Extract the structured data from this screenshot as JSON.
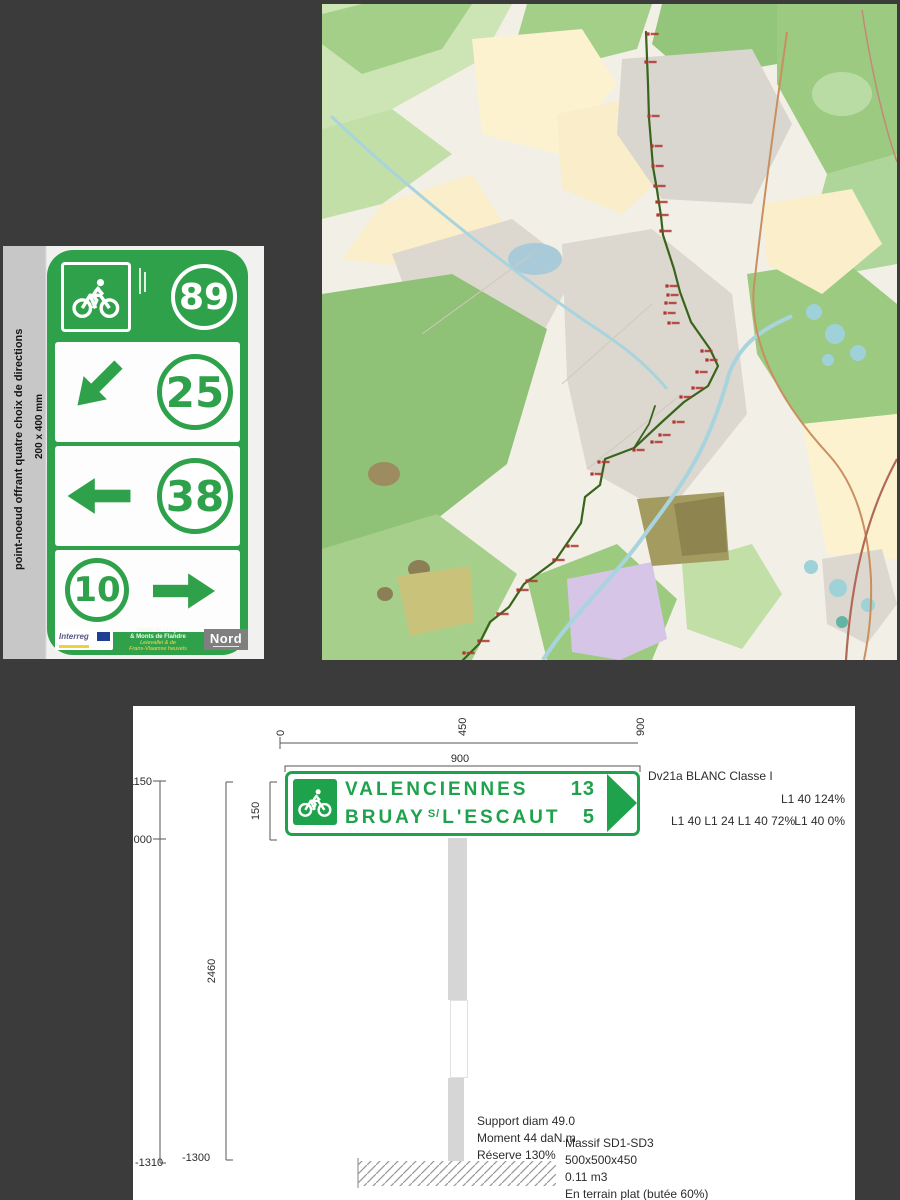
{
  "colors": {
    "canvas_bg": "#3b3b3b",
    "sign_green": "#2fa14b",
    "drawing_green": "#1fa24c",
    "route_green": "#38641c",
    "marker_red": "#b03530",
    "post_gray": "#d6d6d6"
  },
  "sign_panel": {
    "vertical_caption": "point-noeud offrant quatre choix de directions",
    "size_caption": "200 x 400 mm",
    "header": {
      "node_number": "89",
      "pictogram": "bicycle"
    },
    "rows": [
      {
        "arrow": "down-left",
        "number": "25"
      },
      {
        "arrow": "left",
        "number": "38"
      },
      {
        "number": "10",
        "arrow": "right"
      }
    ],
    "footer": {
      "interreg_label": "Interreg",
      "region_lines": [
        "Vallée de la Lys",
        "& Monts de Flandre",
        "Leievallei & de",
        "Frans-Vlaamse heuvels"
      ],
      "nord_label": "Nord"
    }
  },
  "map": {
    "route_color": "#38641c",
    "marker_color": "#b03530",
    "route_points": [
      [
        324,
        28
      ],
      [
        326,
        80
      ],
      [
        327,
        114
      ],
      [
        331,
        163
      ],
      [
        335,
        186
      ],
      [
        339,
        212
      ],
      [
        341,
        231
      ],
      [
        352,
        265
      ],
      [
        358,
        288
      ],
      [
        369,
        318
      ],
      [
        388,
        345
      ],
      [
        396,
        362
      ],
      [
        386,
        382
      ],
      [
        362,
        398
      ],
      [
        341,
        417
      ],
      [
        312,
        444
      ],
      [
        283,
        455
      ],
      [
        278,
        481
      ],
      [
        263,
        493
      ],
      [
        259,
        519
      ],
      [
        233,
        557
      ],
      [
        202,
        580
      ],
      [
        187,
        603
      ],
      [
        168,
        618
      ],
      [
        157,
        640
      ],
      [
        141,
        656
      ]
    ],
    "route_branch": [
      [
        312,
        444
      ],
      [
        327,
        420
      ],
      [
        333,
        402
      ]
    ],
    "markers": [
      [
        326,
        30
      ],
      [
        324,
        58
      ],
      [
        327,
        112
      ],
      [
        330,
        142
      ],
      [
        331,
        162
      ],
      [
        333,
        182
      ],
      [
        335,
        198
      ],
      [
        336,
        211
      ],
      [
        339,
        227
      ],
      [
        345,
        282
      ],
      [
        346,
        291
      ],
      [
        344,
        299
      ],
      [
        343,
        309
      ],
      [
        347,
        319
      ],
      [
        380,
        347
      ],
      [
        385,
        356
      ],
      [
        375,
        368
      ],
      [
        371,
        384
      ],
      [
        359,
        393
      ],
      [
        352,
        418
      ],
      [
        338,
        431
      ],
      [
        330,
        438
      ],
      [
        312,
        446
      ],
      [
        277,
        458
      ],
      [
        270,
        470
      ],
      [
        246,
        542
      ],
      [
        232,
        556
      ],
      [
        205,
        577
      ],
      [
        196,
        586
      ],
      [
        176,
        610
      ],
      [
        157,
        637
      ],
      [
        142,
        649
      ]
    ]
  },
  "drawing": {
    "top_ruler": {
      "labels": [
        "0",
        "450",
        "900"
      ]
    },
    "width_dim": "900",
    "left_dims": {
      "y1150": "1150",
      "y1000": "1000",
      "height": "2460",
      "sign_height": "150",
      "ground_left": "-1310",
      "ground_right": "-1300"
    },
    "sign": {
      "line1": {
        "dest": "VALENCIENNES",
        "dist": "13"
      },
      "line2": {
        "dest_a": "BRUAY",
        "sup": "S/",
        "dest_b": "L'ESCAUT",
        "dist": "5"
      }
    },
    "annotations": {
      "panel_class": "Dv21a BLANC Classe I",
      "l1_top": "L1 40 124%",
      "l1_mid_left": "L1 40 L1 24 L1 40 72%",
      "l1_mid_right": "L1 40 0%"
    },
    "support_block": {
      "l1": "Support diam 49.0",
      "l2": "Moment 44 daN.m",
      "l3": "Réserve 130%"
    },
    "massif_block": {
      "l1": "Massif SD1-SD3",
      "l2": "500x500x450",
      "l3": "0.11 m3",
      "l4": "En terrain plat (butée 60%)"
    }
  }
}
